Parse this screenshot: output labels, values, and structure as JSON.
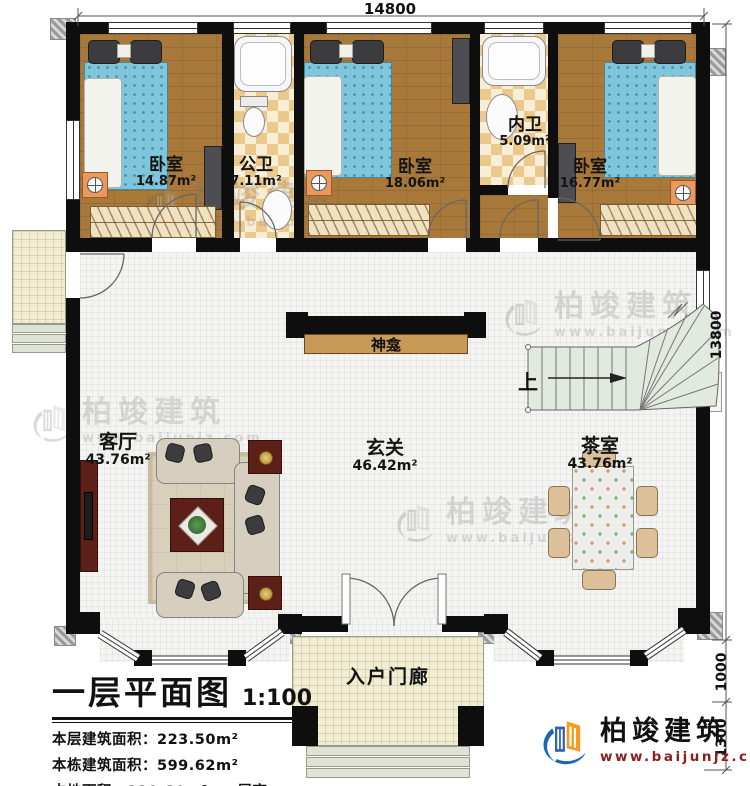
{
  "dimensions": {
    "width_top": "14800",
    "height_right": "13800",
    "porch_depth": "1000",
    "steps_depth": "1300"
  },
  "rooms": {
    "bedroom1": {
      "name": "卧室",
      "area": "14.87m²"
    },
    "public_bath": {
      "name": "公卫",
      "area": "7.11m²"
    },
    "bedroom2": {
      "name": "卧室",
      "area": "18.06m²"
    },
    "inner_bath": {
      "name": "内卫",
      "area": "5.09m²"
    },
    "bedroom3": {
      "name": "卧室",
      "area": "16.77m²"
    },
    "living_room": {
      "name": "客厅",
      "area": "43.76m²"
    },
    "foyer": {
      "name": "玄关",
      "area": "46.42m²"
    },
    "tea_room": {
      "name": "茶室",
      "area": "43.76m²"
    },
    "entry_porch": {
      "name": "入户门廊"
    },
    "shrine": {
      "name": "神龛"
    },
    "stairs": {
      "direction_label": "上"
    }
  },
  "title_block": {
    "plan_title": "一层平面图",
    "scale": "1:100",
    "floor_area_label": "本层建筑面积：",
    "floor_area_value": "223.50m²",
    "building_area_label": "本栋建筑面积：",
    "building_area_value": "599.62m²",
    "land_area_label": "占地面积：",
    "land_area_value": "229.80m²",
    "story_height_label": "层高：",
    "story_height_value": "3.9m"
  },
  "branding": {
    "company_name": "柏竣建筑",
    "website": "www.baijunjz.com"
  },
  "watermark": {
    "company_name": "柏竣建筑",
    "website": "www.baijunjz.com"
  },
  "colors": {
    "wall": "#0e0e0e",
    "wood_floor": "#a8793a",
    "tile_floor": "#ebc88c",
    "hall_floor": "#f4f4f2",
    "stair_fill": "#e2e9df",
    "brand_blue": "#1a66b2",
    "brand_orange": "#f59b1e",
    "brand_red": "#8a2020"
  }
}
